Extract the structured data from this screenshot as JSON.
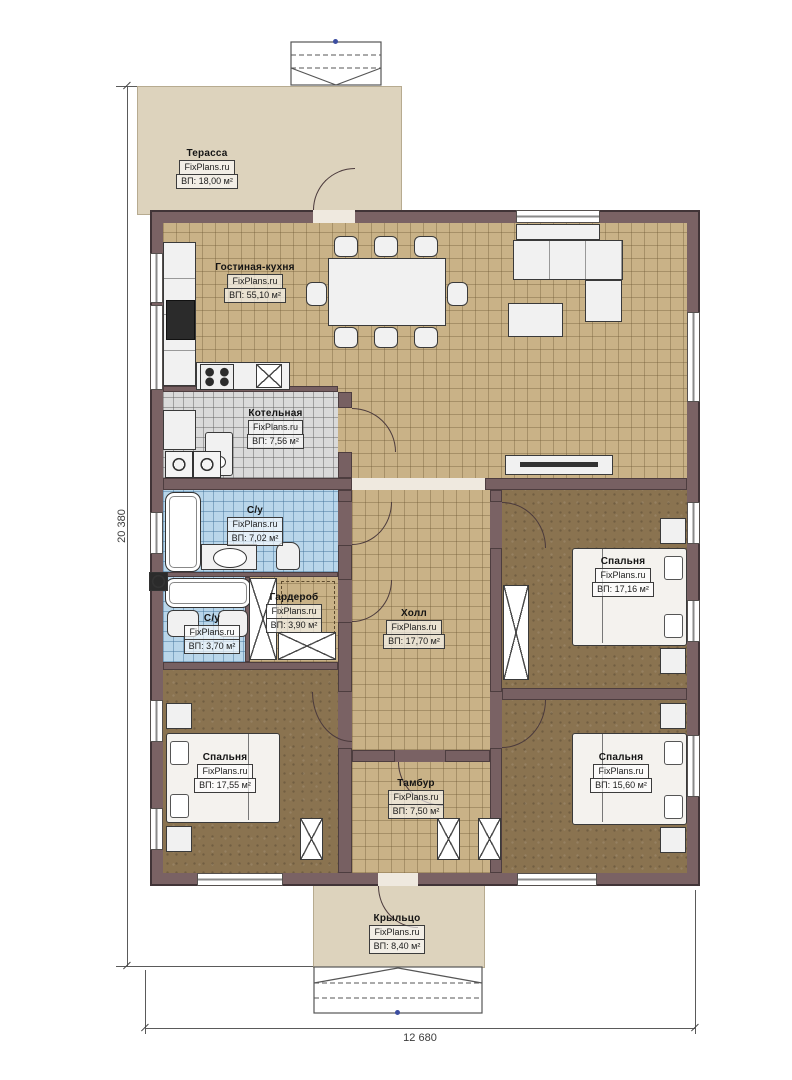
{
  "brand": "FixPlans.ru",
  "dimensions": {
    "vertical": "20 380",
    "horizontal": "12 680"
  },
  "rooms": [
    {
      "key": "terrace",
      "name": "Терасса",
      "site": "FixPlans.ru",
      "area": "ВП: 18,00 м²"
    },
    {
      "key": "living-kitchen",
      "name": "Гостиная-кухня",
      "site": "FixPlans.ru",
      "area": "ВП: 55,10 м²"
    },
    {
      "key": "boiler",
      "name": "Котельная",
      "site": "FixPlans.ru",
      "area": "ВП: 7,56 м²"
    },
    {
      "key": "bathroom-1",
      "name": "С/у",
      "site": "FixPlans.ru",
      "area": "ВП: 7,02 м²"
    },
    {
      "key": "bathroom-2",
      "name": "С/у",
      "site": "FixPlans.ru",
      "area": "ВП: 3,70 м²"
    },
    {
      "key": "wardrobe",
      "name": "Гардероб",
      "site": "FixPlans.ru",
      "area": "ВП: 3,90 м²"
    },
    {
      "key": "hall",
      "name": "Холл",
      "site": "FixPlans.ru",
      "area": "ВП: 17,70 м²"
    },
    {
      "key": "bedroom-right-top",
      "name": "Спальня",
      "site": "FixPlans.ru",
      "area": "ВП: 17,16 м²"
    },
    {
      "key": "bedroom-right-bottom",
      "name": "Спальня",
      "site": "FixPlans.ru",
      "area": "ВП: 15,60 м²"
    },
    {
      "key": "bedroom-left",
      "name": "Спальня",
      "site": "FixPlans.ru",
      "area": "ВП: 17,55 м²"
    },
    {
      "key": "tambour",
      "name": "Тамбур",
      "site": "FixPlans.ru",
      "area": "ВП: 7,50 м²"
    },
    {
      "key": "porch",
      "name": "Крыльцо",
      "site": "FixPlans.ru",
      "area": "ВП: 8,40 м²"
    }
  ],
  "colors": {
    "wall": "#7a6264",
    "terrace": "#ddd3bd",
    "living_floor": "#c9b287",
    "bedroom_floor": "#8a7350",
    "boiler_floor": "#dadada",
    "bath_floor": "#b9d6ea",
    "survey_dot": "#3b4da0"
  }
}
